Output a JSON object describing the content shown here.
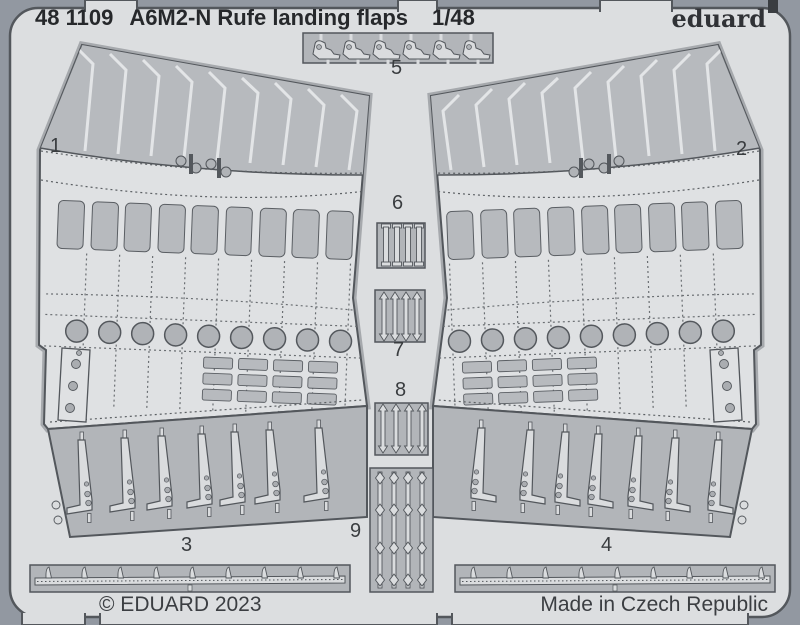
{
  "header": {
    "catalog": "48 1109",
    "title": "A6M2-N Rufe landing flaps",
    "scale": "1/48",
    "brand": "eduard"
  },
  "footer": {
    "copyright": "© EDUARD 2023",
    "origin": "Made in Czech Republic"
  },
  "part_labels": {
    "p1": "1",
    "p2": "2",
    "p3": "3",
    "p4": "4",
    "p5": "5",
    "p6": "6",
    "p7": "7",
    "p8": "8",
    "p9": "9"
  },
  "colors": {
    "background": "#9298a1",
    "fret_sheet": "#dcdee0",
    "recess": "#b2b5b9",
    "part_light": "#dadcde",
    "part_medium": "#b7babe",
    "outline": "#53575c",
    "text": "#2e3134"
  }
}
